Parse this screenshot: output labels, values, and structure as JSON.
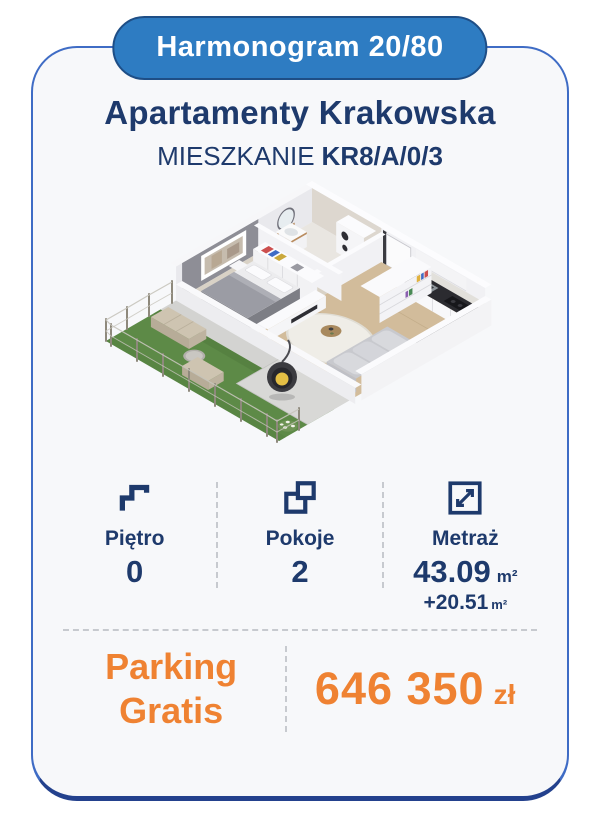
{
  "badge": {
    "label": "Harmonogram 20/80"
  },
  "header": {
    "title": "Apartamenty Krakowska",
    "subtitle_prefix": "MIESZKANIE",
    "unit_code": "KR8/A/0/3"
  },
  "floor_plan": {
    "alt": "3D isometric floor plan of a 2-room apartment with bedroom, bathroom, hall, kitchen with living room, and a fenced garden terrace with outdoor furniture and a hanging egg chair"
  },
  "stats": {
    "floor": {
      "icon": "stairs-icon",
      "label": "Piętro",
      "value": "0"
    },
    "rooms": {
      "icon": "rooms-icon",
      "label": "Pokoje",
      "value": "2"
    },
    "area": {
      "icon": "area-icon",
      "label": "Metraż",
      "value": "43.09",
      "unit": "m²",
      "extra_value": "+20.51",
      "extra_unit": "m²"
    }
  },
  "offer": {
    "promo_line1": "Parking",
    "promo_line2": "Gratis",
    "price": "646 350",
    "currency": "zł"
  },
  "colors": {
    "navy": "#1E3A6C",
    "badge_blue": "#2E7CC2",
    "orange": "#EF8232",
    "card_bg": "#F7F8FA",
    "border_blue": "#3F6CC5",
    "dash_gray": "#C7CACF"
  }
}
